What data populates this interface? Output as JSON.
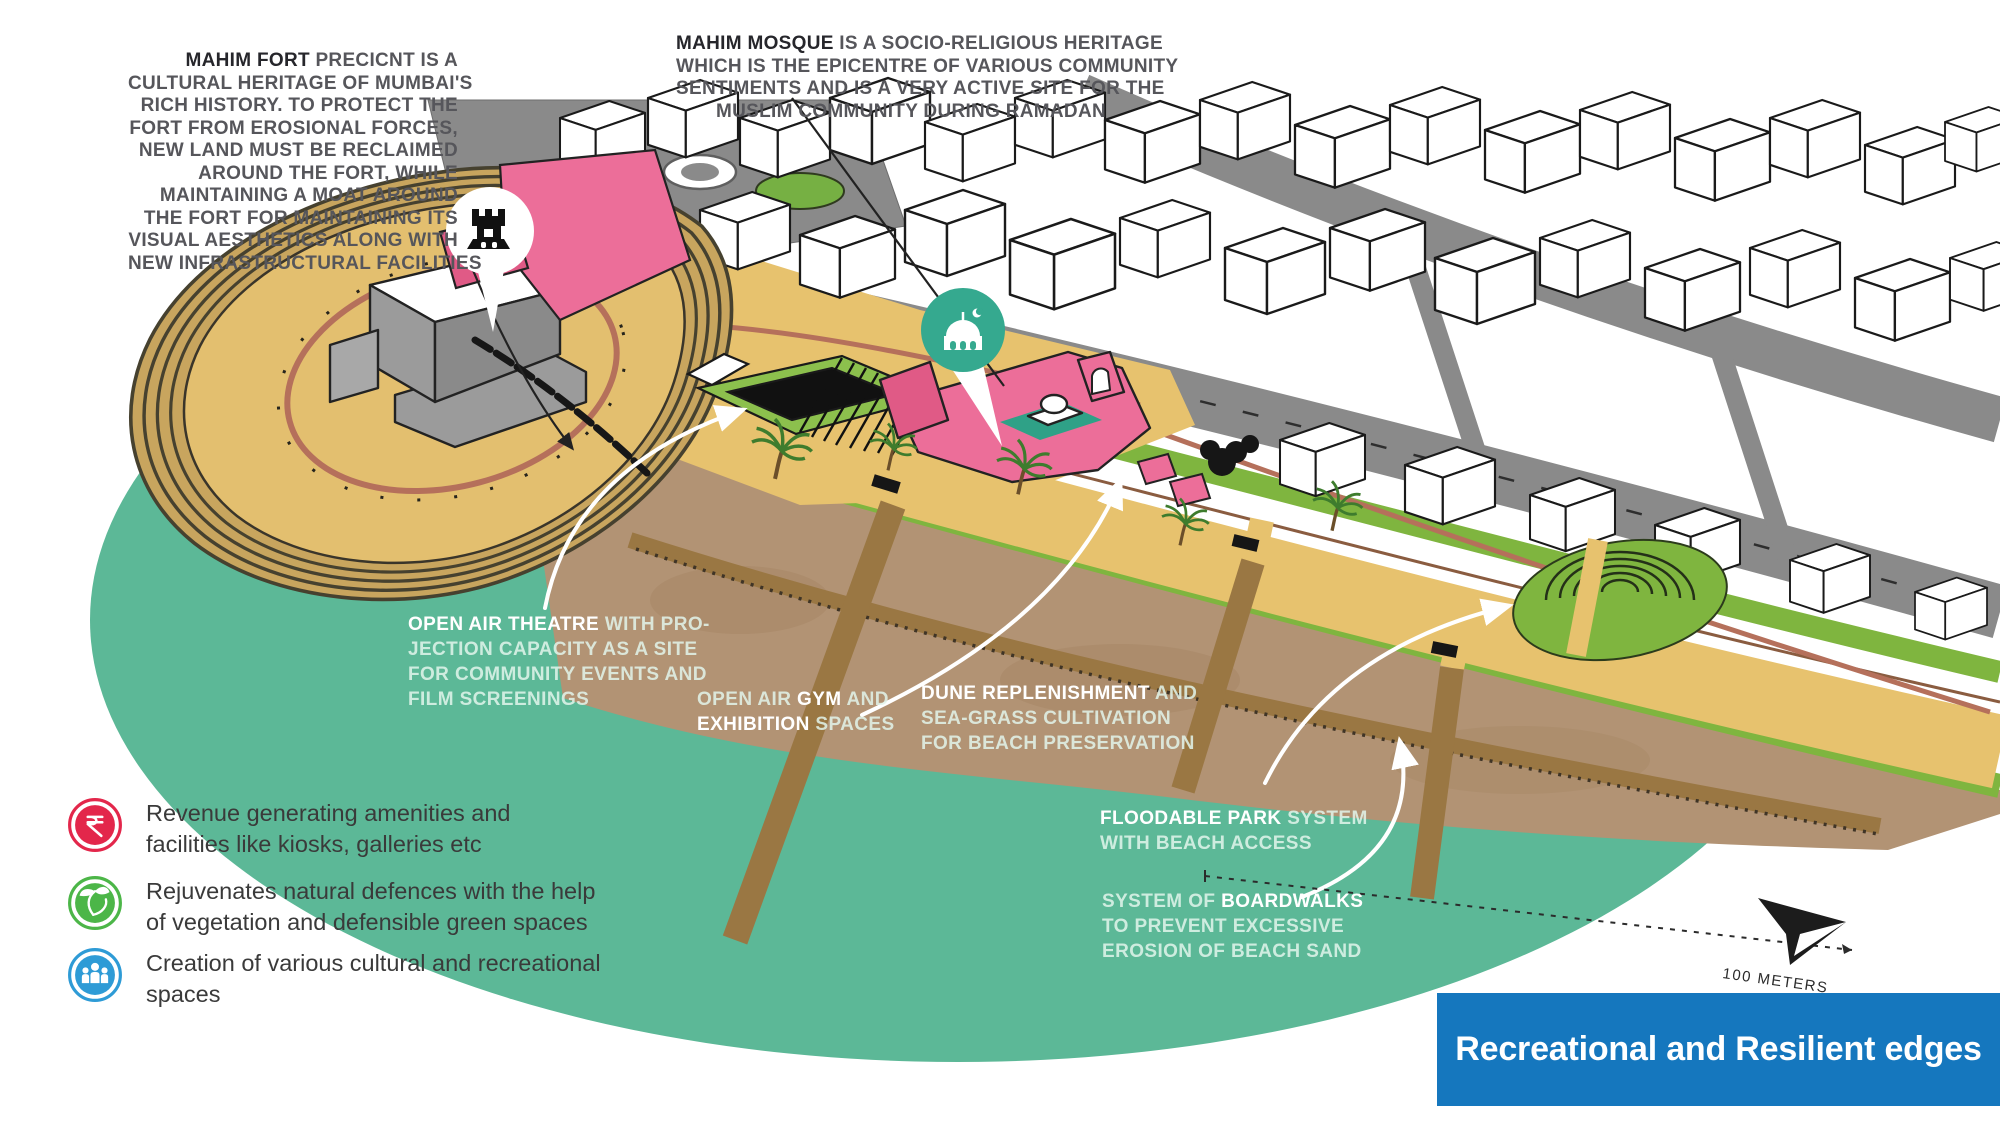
{
  "banner": {
    "title": "Recreational and Resilient edges"
  },
  "annotations": {
    "fort": {
      "lines": [
        {
          "b": "MAHIM FORT",
          "post": " PRECICNT IS A"
        },
        {
          "text": "CULTURAL HERITAGE OF MUMBAI'S"
        },
        {
          "text": "RICH HISTORY. TO PROTECT THE"
        },
        {
          "text": "FORT FROM EROSIONAL FORCES,"
        },
        {
          "text": "NEW LAND MUST BE RECLAIMED"
        },
        {
          "text": "AROUND THE FORT, WHILE"
        },
        {
          "text": "MAINTAINING A MOAT AROUND"
        },
        {
          "text": "THE FORT FOR MAINTAINING ITS"
        },
        {
          "text": "VISUAL AESTHETICS ALONG WITH"
        },
        {
          "text": "NEW INFRASTRUCTURAL FACILITIES"
        }
      ]
    },
    "mosque": {
      "lines": [
        {
          "b": "MAHIM MOSQUE",
          "post": " IS A SOCIO-RELIGIOUS HERITAGE"
        },
        {
          "text": "WHICH IS THE EPICENTRE OF VARIOUS COMMUNITY"
        },
        {
          "text": "SENTIMENTS AND IS A VERY ACTIVE SITE FOR THE"
        },
        {
          "text": "MUSLIM COMMUNITY DURING RAMADAN"
        }
      ]
    }
  },
  "map_labels": {
    "theatre": {
      "lines": [
        {
          "b": "OPEN AIR THEATRE",
          "post": " WITH PRO-"
        },
        {
          "text": "JECTION CAPACITY AS A SITE"
        },
        {
          "text": "FOR COMMUNITY EVENTS AND"
        },
        {
          "text": "FILM SCREENINGS"
        }
      ]
    },
    "gym": {
      "lines": [
        {
          "pre": "OPEN AIR ",
          "b": "GYM",
          "post": " AND"
        },
        {
          "b": "EXHIBITION",
          "post": " SPACES"
        }
      ]
    },
    "dune": {
      "lines": [
        {
          "b": "DUNE REPLENISHMENT",
          "post": " AND"
        },
        {
          "text": "SEA-GRASS CULTIVATION"
        },
        {
          "text": "FOR BEACH PRESERVATION"
        }
      ]
    },
    "floodable": {
      "lines": [
        {
          "b": "FLOODABLE PARK",
          "post": " SYSTEM"
        },
        {
          "text": "WITH BEACH ACCESS"
        }
      ]
    },
    "boardwalks": {
      "lines": [
        {
          "pre": "SYSTEM OF ",
          "b": "BOARDWALKS"
        },
        {
          "text": "TO PREVENT EXCESSIVE"
        },
        {
          "text": "EROSION OF BEACH SAND"
        }
      ]
    }
  },
  "legend": {
    "items": [
      {
        "icon": "rupee-icon",
        "color": "#E3274B",
        "lines": [
          "Revenue generating amenities and",
          "facilities like kiosks, galleries etc"
        ]
      },
      {
        "icon": "leaf-icon",
        "color": "#4CB648",
        "lines": [
          "Rejuvenates natural defences with the help",
          "of vegetation and defensible green spaces"
        ]
      },
      {
        "icon": "people-icon",
        "color": "#2E9BD6",
        "lines": [
          "Creation of various cultural and recreational",
          "spaces"
        ]
      }
    ]
  },
  "scale": {
    "label": "100 METERS"
  },
  "icons": {
    "fort_badge": "fort-castle-icon",
    "mosque_badge": "mosque-icon",
    "north": "north-arrow-icon"
  },
  "palette": {
    "water": "#5CB897",
    "sand": "#B29374",
    "promenade": "#E7C26E",
    "greenery": "#7FB53F",
    "road": "#8A8A8A",
    "heritage_pink": "#EC6E99",
    "boardwalk_brown": "#9A7743",
    "banner_blue": "#1577BE",
    "badge_teal": "#35A98F",
    "rupee_red": "#E3274B",
    "leaf_green": "#4CB648",
    "people_blue": "#2E9BD6"
  }
}
